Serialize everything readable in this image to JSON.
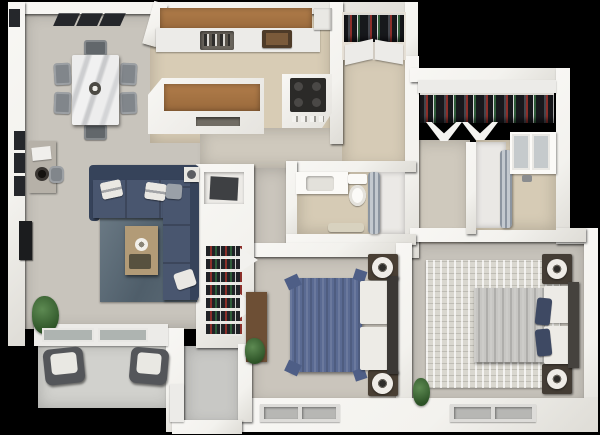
{
  "scene": {
    "type": "3d-rendered-apartment-floor-plan",
    "description": "Top-down 3D render of a two-bedroom, two-bath apartment with open living/dining/kitchen, hallway closets, patio and entry, on a black background",
    "visible_text": []
  },
  "colors": {
    "bg": "#000000",
    "wall": "#f3f2ee",
    "wall-light": "#ecebe8",
    "carpet": "#c8c4bc",
    "wood-floor": "#d8ccb5",
    "corridor-floor": "#cfc9bd",
    "hallway-floor": "#d6cbb6",
    "bath-floor": "#d6cbb5",
    "patio-floor": "#d1d1cd",
    "entry-floor": "#c8c8c5",
    "bedroom-floor": "#cac5bc",
    "bedroom2-floor": "#c7c3bb",
    "rug-living-a": "#6b7a85",
    "rug-living-b": "#4f5e6a",
    "rug-bedroom": "#d9d7cf",
    "sofa": "#49566f",
    "sofa-dark": "#36435a",
    "pillow": "#eae8e3",
    "pillow-gray": "#9aa0a8",
    "coffee-table": "#b29b77",
    "tray-dark": "#57513f",
    "chair": "#81868b",
    "chair-dark": "#62676b",
    "console": "#b6b1a8",
    "wood-counter": "#b07c4a",
    "sink": "#6a655d",
    "cooktop": "#2b2a28",
    "dishwasher": "#716c64",
    "appliance": "#e9e8e4",
    "clothes-dark": "#17181c",
    "clothes-mid": "#44474e",
    "clothes-red": "#8c2f2a",
    "clothes-green": "#2e5c39",
    "clothes-light": "#d8d8d8",
    "shoe-a": "#202226",
    "glass": "#aeb4b1",
    "curtain-a": "#8c95a0",
    "curtain-b": "#c3c9cf",
    "mirror": "#c5cacc",
    "porcelain": "#fbfaf7",
    "mat": "#d8d2bf",
    "duvet-blue": "#5a6a92",
    "duvet-blue-dark": "#4e5e86",
    "duvet-gray": "#c7c6c3",
    "mattress": "#edebe6",
    "headboard": "#3b3835",
    "nightstand": "#493f34",
    "lamp-shade": "#efece7",
    "lamp-dark": "#2e2c29",
    "dresser": "#6d4f35",
    "plant-a": "#5d8a52",
    "plant-b": "#2c5226",
    "tv": "#1b1c1e",
    "window-dark": "#25272b",
    "window-frame": "#dddcd9",
    "window-pane": "#b7b7b4",
    "patio-chair": "#54565a",
    "patio-cushion": "#e9e8e3"
  },
  "rooms": [
    {
      "name": "dining-area",
      "furniture": [
        "marble-dining-table",
        "dining-chairs-x6",
        "console-table",
        "stool",
        "wall-windows-x3",
        "ceiling-vents-x3"
      ]
    },
    {
      "name": "kitchen",
      "furniture": [
        "wood-upper-cabinets",
        "countertop-with-sink",
        "dish-items",
        "serving-tray",
        "refrigerator",
        "kitchen-island-wood-top",
        "dishwasher",
        "range-cooktop"
      ]
    },
    {
      "name": "living-room",
      "furniture": [
        "navy-sectional-sofa",
        "throw-pillows",
        "blue-gray-area-rug",
        "coffee-table",
        "decor-bowl",
        "wall-mounted-tv",
        "floor-plant",
        "side-table-lamp",
        "sliding-glass-door"
      ]
    },
    {
      "name": "hall-closet",
      "furniture": [
        "hanging-clothes",
        "bifold-doors"
      ]
    },
    {
      "name": "hallway",
      "furniture": []
    },
    {
      "name": "shoe-closet",
      "furniture": [
        "storage-cabinet",
        "shoe-shelves",
        "accordion-doors"
      ]
    },
    {
      "name": "bathroom-1",
      "furniture": [
        "vanity-sink",
        "toilet",
        "curtained-shower",
        "bath-mat"
      ]
    },
    {
      "name": "bedroom-1",
      "furniture": [
        "blue-upholstered-bed",
        "nightstands-x2",
        "round-lamps-x2",
        "wood-dresser",
        "plant",
        "window"
      ]
    },
    {
      "name": "walk-in-closet",
      "furniture": [
        "clothes-rail",
        "bifold-doors",
        "shelf"
      ]
    },
    {
      "name": "bathroom-2",
      "furniture": [
        "curtained-shower",
        "vanity",
        "mirror-cabinets"
      ]
    },
    {
      "name": "bedroom-2",
      "furniture": [
        "gray-bed",
        "navy-accent-pillows",
        "nightstands-x2",
        "round-lamps-x2",
        "distressed-area-rug",
        "plant",
        "window"
      ]
    },
    {
      "name": "patio",
      "furniture": [
        "lounge-chairs-x2",
        "concrete-slab"
      ]
    },
    {
      "name": "entry-vestibule",
      "furniture": [
        "step-landing"
      ]
    }
  ]
}
